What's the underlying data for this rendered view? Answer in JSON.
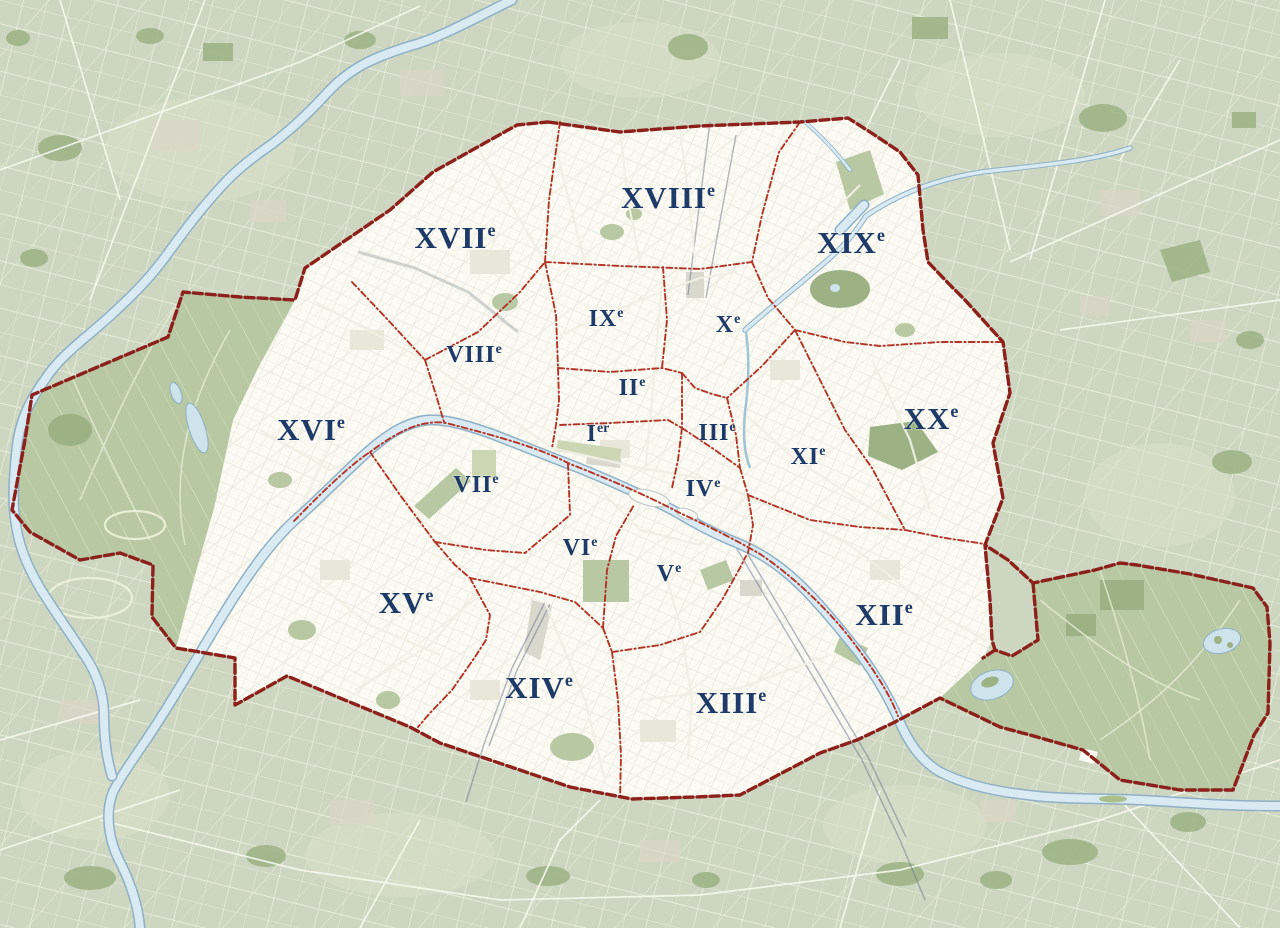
{
  "map": {
    "region_labels": [
      {
        "name": "arrondissement-18",
        "roman": "XVIII",
        "sup": "e",
        "x": 668,
        "y": 208,
        "size": "large"
      },
      {
        "name": "arrondissement-17",
        "roman": "XVII",
        "sup": "e",
        "x": 455,
        "y": 248,
        "size": "large"
      },
      {
        "name": "arrondissement-19",
        "roman": "XIX",
        "sup": "e",
        "x": 851,
        "y": 253,
        "size": "large"
      },
      {
        "name": "arrondissement-9",
        "roman": "IX",
        "sup": "e",
        "x": 606,
        "y": 326,
        "size": "small"
      },
      {
        "name": "arrondissement-10",
        "roman": "X",
        "sup": "e",
        "x": 728,
        "y": 332,
        "size": "small"
      },
      {
        "name": "arrondissement-8",
        "roman": "VIII",
        "sup": "e",
        "x": 474,
        "y": 362,
        "size": "small"
      },
      {
        "name": "arrondissement-2",
        "roman": "II",
        "sup": "e",
        "x": 632,
        "y": 395,
        "size": "small"
      },
      {
        "name": "arrondissement-16",
        "roman": "XVI",
        "sup": "e",
        "x": 311,
        "y": 440,
        "size": "large"
      },
      {
        "name": "arrondissement-1",
        "roman": "I",
        "sup": "er",
        "x": 598,
        "y": 441,
        "size": "small"
      },
      {
        "name": "arrondissement-3",
        "roman": "III",
        "sup": "e",
        "x": 717,
        "y": 440,
        "size": "small"
      },
      {
        "name": "arrondissement-11",
        "roman": "XI",
        "sup": "e",
        "x": 808,
        "y": 464,
        "size": "small"
      },
      {
        "name": "arrondissement-20",
        "roman": "XX",
        "sup": "e",
        "x": 931,
        "y": 429,
        "size": "large"
      },
      {
        "name": "arrondissement-7",
        "roman": "VII",
        "sup": "e",
        "x": 476,
        "y": 492,
        "size": "small"
      },
      {
        "name": "arrondissement-4",
        "roman": "IV",
        "sup": "e",
        "x": 703,
        "y": 496,
        "size": "small"
      },
      {
        "name": "arrondissement-6",
        "roman": "VI",
        "sup": "e",
        "x": 580,
        "y": 555,
        "size": "small"
      },
      {
        "name": "arrondissement-5",
        "roman": "V",
        "sup": "e",
        "x": 669,
        "y": 581,
        "size": "small"
      },
      {
        "name": "arrondissement-15",
        "roman": "XV",
        "sup": "e",
        "x": 406,
        "y": 613,
        "size": "large"
      },
      {
        "name": "arrondissement-12",
        "roman": "XII",
        "sup": "e",
        "x": 884,
        "y": 625,
        "size": "large"
      },
      {
        "name": "arrondissement-14",
        "roman": "XIV",
        "sup": "e",
        "x": 539,
        "y": 698,
        "size": "large"
      },
      {
        "name": "arrondissement-13",
        "roman": "XIII",
        "sup": "e",
        "x": 731,
        "y": 713,
        "size": "large"
      }
    ],
    "colors": {
      "background": "#ccd6c0",
      "suburb_field": "#d9e0c9",
      "woodland": "#9db586",
      "suburb_built": "#d9d6c7",
      "city_fill": "#fbfaf3",
      "city_block": "#e9e7da",
      "park_fill": "#b7c8a2",
      "park_dark": "#9cb284",
      "water_fill": "#d9eaf2",
      "water_edge": "#8fb0c6",
      "rail": "#64748c",
      "outer_boundary": "#8c211b",
      "inner_boundary": "#b23427",
      "label": "#1d3a69",
      "road_outside": "#f7f8ef",
      "road_city": "#f0efe4"
    }
  }
}
